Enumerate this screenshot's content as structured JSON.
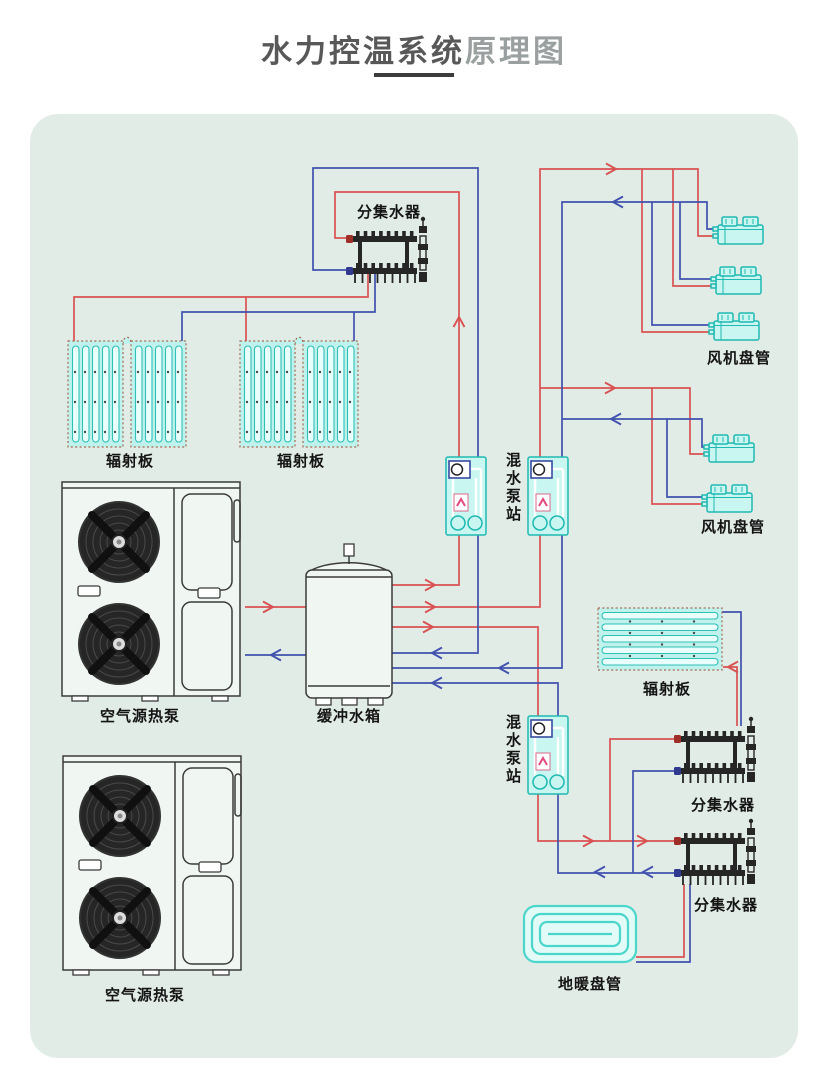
{
  "title": {
    "main": "水力控温系统",
    "sub": "原理图"
  },
  "labels": {
    "manifold_top": "分集水器",
    "radiant_panel_left_1": "辐射板",
    "radiant_panel_left_2": "辐射板",
    "heat_pump_1": "空气源热泵",
    "heat_pump_2": "空气源热泵",
    "buffer_tank": "缓冲水箱",
    "mixing_station_1": "混水泵站",
    "mixing_station_2": "混水泵站",
    "fan_coil_group_1": "风机盘管",
    "fan_coil_group_2": "风机盘管",
    "radiant_panel_right": "辐射板",
    "manifold_right_upper": "分集水器",
    "manifold_right_lower": "分集水器",
    "floor_heating_coil": "地暖盘管"
  },
  "colors": {
    "page_background": "#ffffff",
    "panel_background": "#e2ece6",
    "supply_red": "#d95252",
    "return_blue": "#4152ae",
    "component_stroke": "#1fb9b1",
    "component_fill": "#c9f6f1",
    "radiant_fill": "#bff2ec",
    "radiant_border": "#a2684f",
    "tube_fill": "#e9fffc",
    "coil_stroke": "#4ad6ca",
    "coil_fill": "#e2fbf7",
    "dark_line": "#3b3b3b",
    "unit_fill": "#f0f6f2",
    "title_main": "#585858",
    "title_sub": "#9aa0a0",
    "label_text": "#141414",
    "underline": "#3c3c3c"
  }
}
